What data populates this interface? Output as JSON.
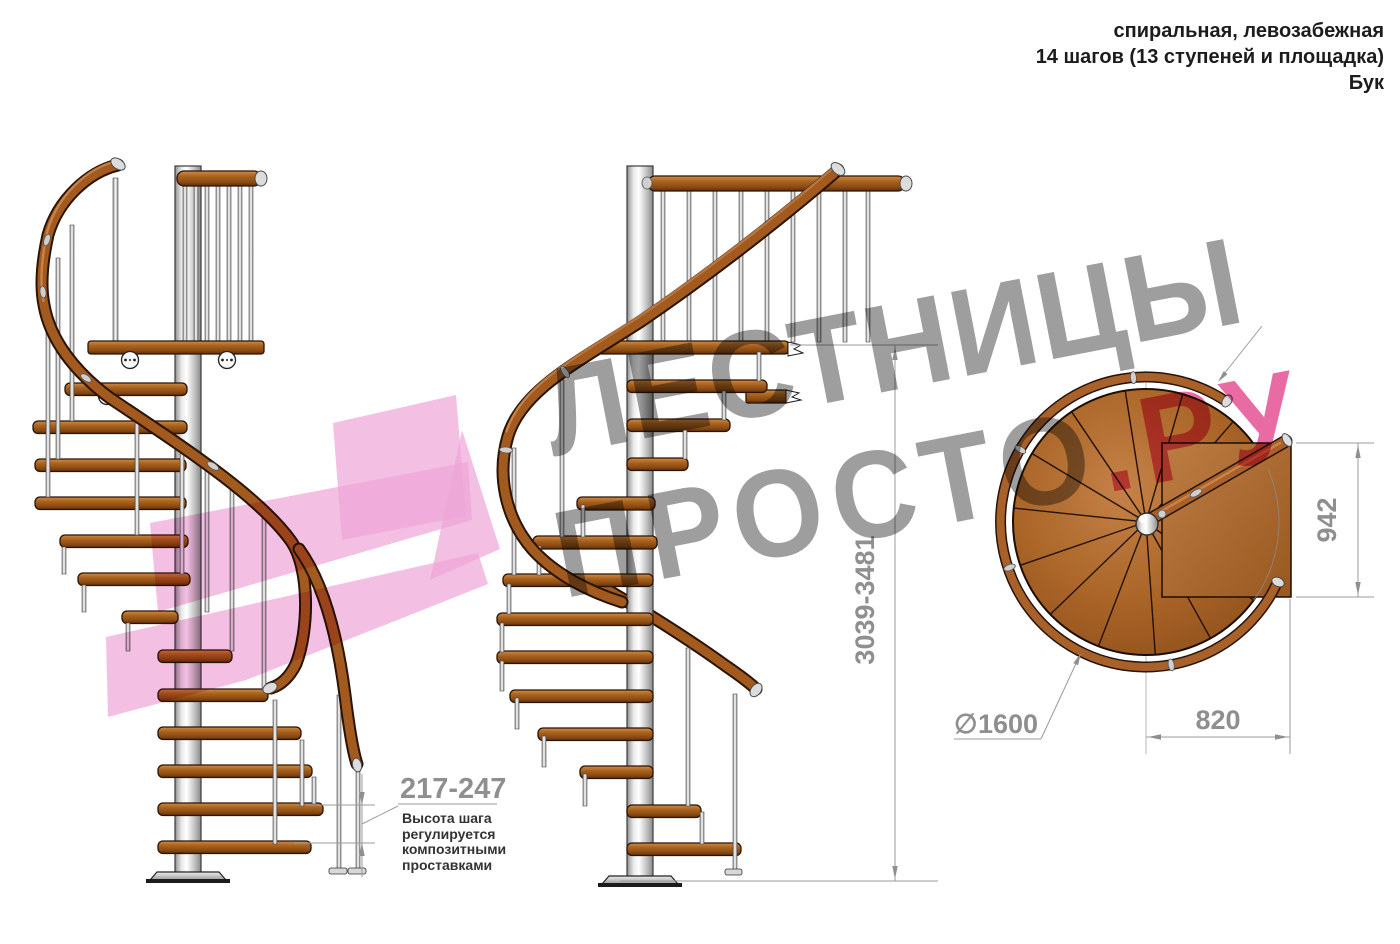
{
  "header": {
    "line1": "спиральная, левозабежная",
    "line2": "14 шагов (13 ступеней и площадка)",
    "line3": "Бук"
  },
  "watermark": {
    "word1": "ЛЕСТНИЦЫ",
    "word2": "ПРОСТО",
    "word3": ".РУ"
  },
  "dimensions": {
    "total_height": "3039-3481",
    "platform_width": "942",
    "platform_depth": "820",
    "diameter_prefix": "∅",
    "diameter_value": "1600",
    "step_height": "217-247"
  },
  "note": {
    "line1": "Высота шага",
    "line2": "регулируется",
    "line3": "композитными",
    "line4": "проставками"
  },
  "colors": {
    "wood": "#a9631f",
    "steel": "#c9c9c9",
    "dimension_gray": "#8f8f8f",
    "note_text": "#333333",
    "watermark_gray": "#9e9e9e",
    "watermark_pink": "#e86ba4",
    "arrow_pink": "#efa6d8"
  }
}
